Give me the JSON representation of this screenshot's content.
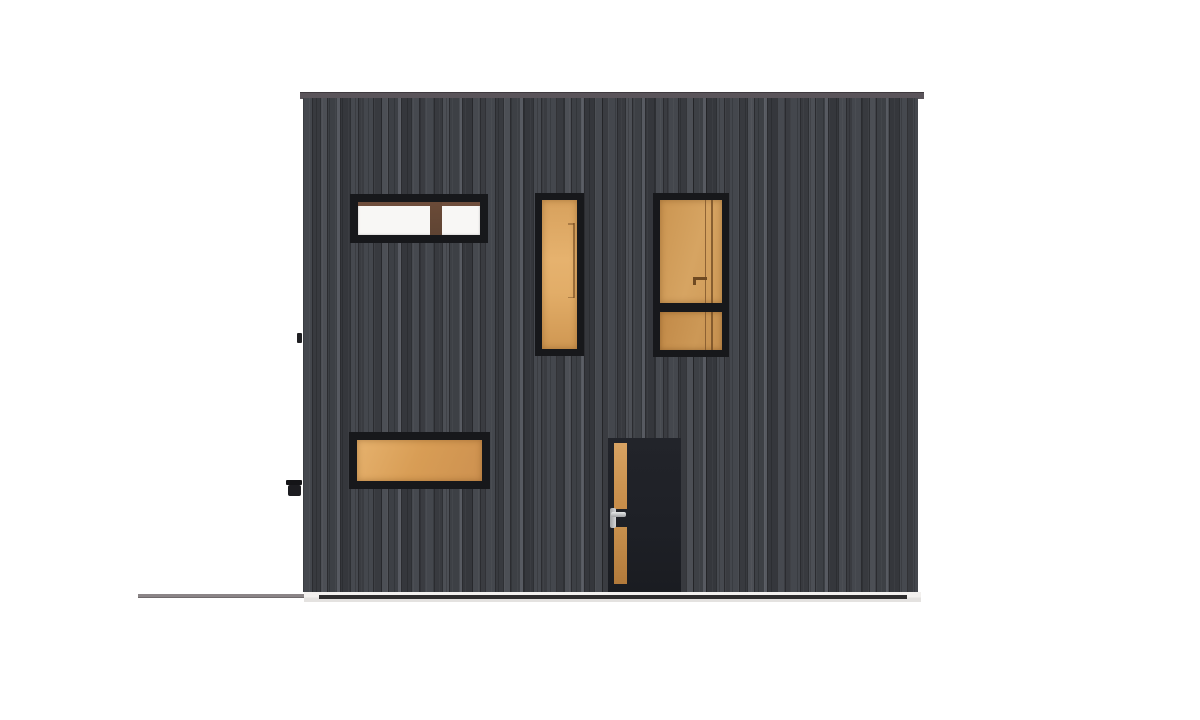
{
  "scene": {
    "name": "Front elevation of a modern house",
    "type": "architectural-elevation-rendering",
    "building": {
      "cladding": "dark charcoal vertical timber boards",
      "roof": "flat roof with grey fascia trim slightly overhanging both sides",
      "base": "white plinth strip with dark shadow groove",
      "ground": "grey ground line extending to the left of the building"
    },
    "openings": [
      {
        "id": "clerestory-window",
        "description": "wide horizontal window, two clear white panes split by a brown mullion with brown head strip",
        "glazing": "white"
      },
      {
        "id": "tall-window-left",
        "description": "narrow full-height vertical window with amber glazing and faint interior reflection line",
        "glazing": "amber"
      },
      {
        "id": "tall-window-right",
        "description": "tall window with large upper pane and small lower pane; interior door edge and handle visible through amber glass",
        "glazing": "amber"
      },
      {
        "id": "low-window",
        "description": "wide low horizontal window with amber glazing",
        "glazing": "amber"
      },
      {
        "id": "entry-door",
        "description": "black entry door with narrow vertical amber glass slot and stainless lever handle",
        "glazing": "amber"
      }
    ],
    "fixtures": [
      {
        "id": "outdoor-tap",
        "description": "small black wall fixture protruding from left edge near the base"
      },
      {
        "id": "wall-bracket",
        "description": "tiny black bracket on left facade edge at mid height"
      }
    ]
  },
  "colors": {
    "page_bg": "#ffffff",
    "cladding_base": "#3d4045",
    "cladding_mid": "#44474d",
    "cladding_light": "#575a61",
    "cladding_gap": "#2b2c30",
    "frame_black": "#17181b",
    "roof_trim": "#5a545a",
    "roof_trim_edge": "#3f3a3f",
    "glazing_white": "#f8f7f5",
    "mullion_brown": "#5f4433",
    "mullion_top": "#6f4e3c",
    "amber_light": "#e6b26e",
    "amber_mid": "#d7a15d",
    "amber_deep": "#cd9150",
    "amber_dark": "#b27a3b",
    "door_black": "#1e2026",
    "handle_silver_light": "#e8e9ea",
    "handle_silver_dark": "#a0a1a4",
    "plinth_white": "#f2f0ee",
    "plinth_groove": "#2e2d2e",
    "ground_line": "#8b8587",
    "fixture_black": "#1c1c20"
  }
}
